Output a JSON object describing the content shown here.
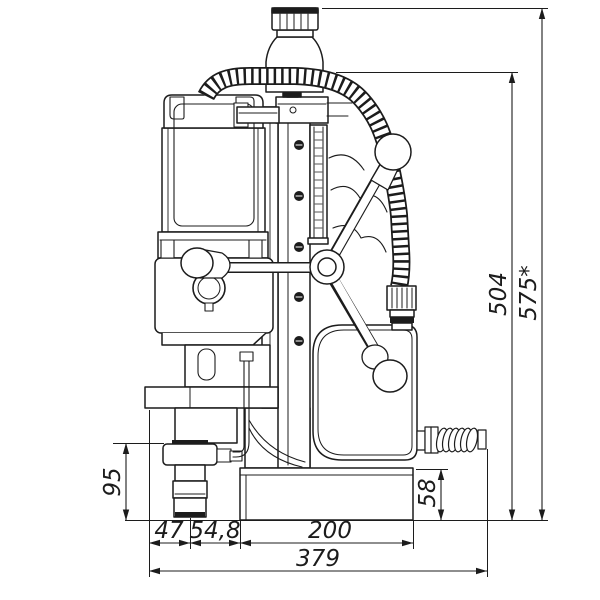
{
  "drawing": {
    "subject": "magnetic-drill-press-front-view",
    "style": "technical-dimension-drawing"
  },
  "colors": {
    "line": "#1c1c1c",
    "background": "#ffffff"
  },
  "dimensions": {
    "vertical": [
      {
        "name": "overall-height-max",
        "label": "575*",
        "x": 542,
        "yTop": 8,
        "yBottom": 520.5,
        "textX": 536,
        "textY": 293
      },
      {
        "name": "machine-height",
        "label": "504",
        "x": 512,
        "yTop": 72,
        "yBottom": 520.5,
        "textX": 506,
        "textY": 294
      },
      {
        "name": "base-height",
        "label": "58",
        "x": 441,
        "yTop": 469,
        "yBottom": 520.5,
        "textX": 435,
        "textY": 493
      },
      {
        "name": "arbor-length",
        "label": "95",
        "x": 126,
        "yTop": 443,
        "yBottom": 520.5,
        "textX": 120,
        "textY": 482
      }
    ],
    "horizontal": [
      {
        "name": "bracket-to-axis",
        "label": "47",
        "y": 543,
        "xLeft": 149,
        "xRight": 190,
        "textX": 169,
        "textY": 538
      },
      {
        "name": "axis-to-base-front",
        "label": "54,8",
        "y": 543,
        "xLeft": 190,
        "xRight": 240,
        "textX": 215,
        "textY": 538
      },
      {
        "name": "base-length",
        "label": "200",
        "y": 543,
        "xLeft": 240,
        "xRight": 413,
        "textX": 330,
        "textY": 538
      },
      {
        "name": "overall-depth",
        "label": "379",
        "y": 571,
        "xLeft": 149,
        "xRight": 487,
        "textX": 318,
        "textY": 566
      }
    ]
  }
}
